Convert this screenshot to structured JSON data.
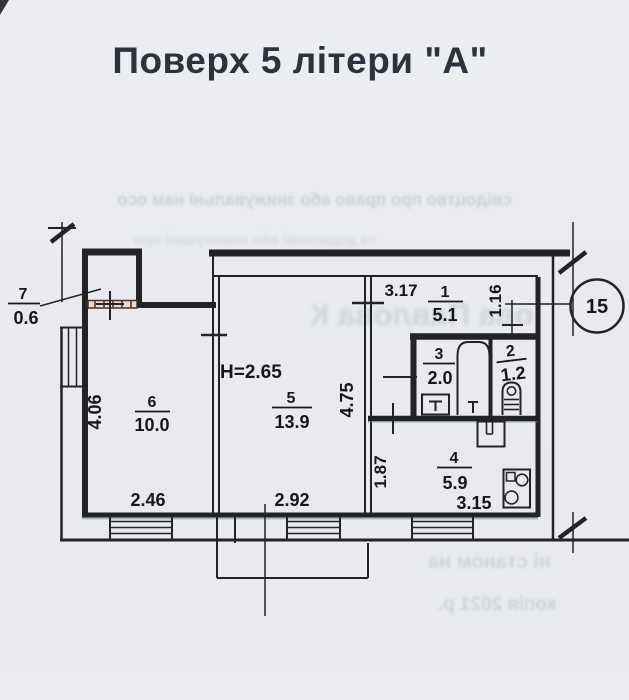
{
  "title": "Поверх 5 літери \"А\"",
  "plan": {
    "axis_circle_label": "15",
    "height_note": "H=2.65",
    "rooms": {
      "r1": {
        "num": "1",
        "area": "5.1"
      },
      "r2": {
        "num": "2",
        "area": "1.2"
      },
      "r3": {
        "num": "3",
        "area": "2.0"
      },
      "r4": {
        "num": "4",
        "area": "5.9"
      },
      "r5": {
        "num": "5",
        "area": "13.9"
      },
      "r6": {
        "num": "6",
        "area": "10.0"
      },
      "r7": {
        "num": "7",
        "area": "0.6"
      }
    },
    "dims": {
      "corridor_width": "3.17",
      "hall_right": "1.16",
      "room5_side": "4.75",
      "kitchen_side": "1.87",
      "kitchen_width": "3.15",
      "room5_width": "2.92",
      "room6_width": "2.46",
      "room6_side": "4.06"
    }
  },
  "bleedthrough": {
    "line1": "свідоцтво про право або знижувальні нам осо",
    "line2": "та додаткові або виконувані при",
    "line3": "ова Павлова К",
    "line4": "ні станом на",
    "line5": "копія            2021 р."
  }
}
